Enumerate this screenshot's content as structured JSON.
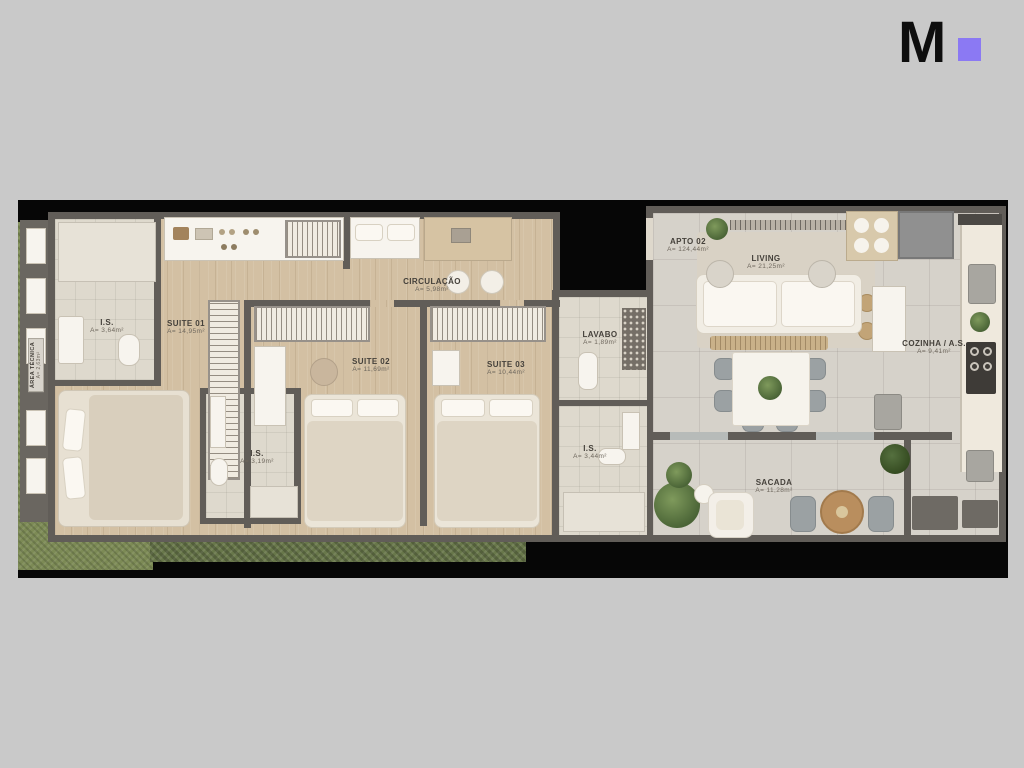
{
  "page": {
    "background_color": "#c9c9c9",
    "frame_color": "#060606"
  },
  "logo": {
    "letter": "M",
    "accent_color": "#8b79f3"
  },
  "plan": {
    "rooms": [
      {
        "id": "area-tecnica",
        "name": "ÁREA TÉCNICA",
        "area": "A= 2,63m²"
      },
      {
        "id": "is-top",
        "name": "I.S.",
        "area": "A= 3,64m²"
      },
      {
        "id": "suite-01",
        "name": "SUITE 01",
        "area": "A= 14,95m²"
      },
      {
        "id": "circulacao",
        "name": "CIRCULAÇÃO",
        "area": "A= 5,98m²"
      },
      {
        "id": "suite-02",
        "name": "SUITE 02",
        "area": "A= 11,69m²"
      },
      {
        "id": "suite-03",
        "name": "SUITE 03",
        "area": "A= 10,44m²"
      },
      {
        "id": "is-mid",
        "name": "I.S.",
        "area": "A= 3,19m²"
      },
      {
        "id": "lavabo",
        "name": "LAVABO",
        "area": "A= 1,89m²"
      },
      {
        "id": "is-right",
        "name": "I.S.",
        "area": "A= 3,44m²"
      },
      {
        "id": "apto-02",
        "name": "APTO 02",
        "area": "A= 124,44m²"
      },
      {
        "id": "living",
        "name": "LIVING",
        "area": "A= 21,25m²"
      },
      {
        "id": "cozinha",
        "name": "COZINHA / A.S.",
        "area": "A= 9,41m²"
      },
      {
        "id": "sacada",
        "name": "SACADA",
        "area": "A= 11,28m²"
      }
    ],
    "colors": {
      "wall": "#615d58",
      "wood_floor": "#d3c0a3",
      "tile_floor": "#d6d2ca",
      "bath_floor": "#ded9cd",
      "grass": "#7c8a55"
    }
  }
}
